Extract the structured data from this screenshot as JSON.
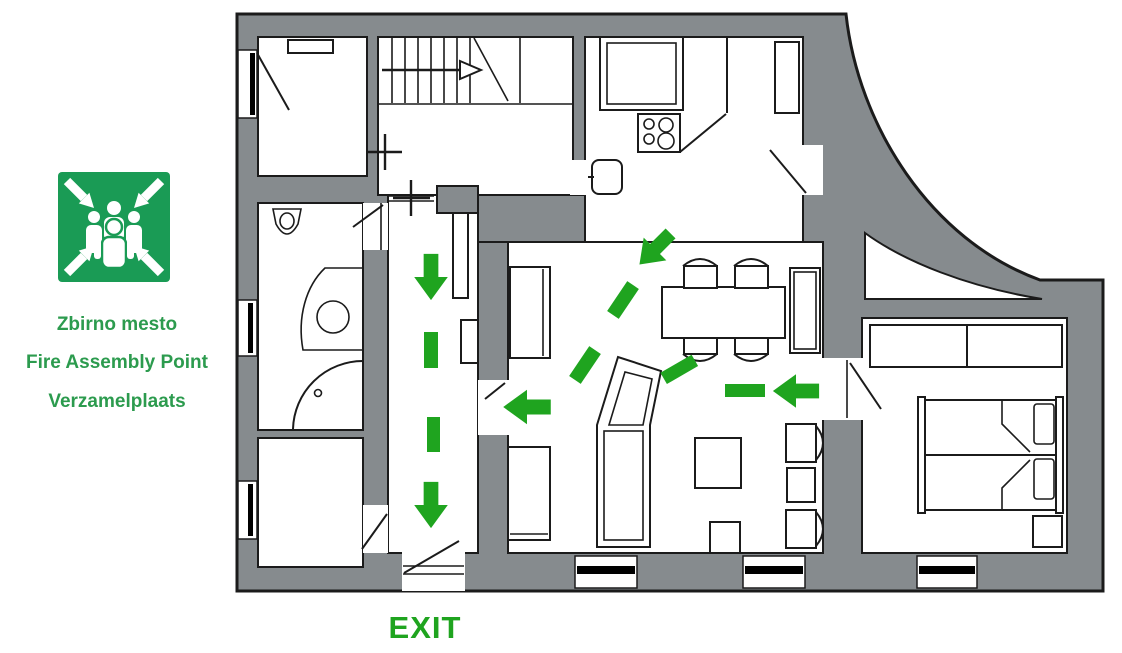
{
  "sign": {
    "icon": "fire-assembly-point",
    "lines": [
      "Zbirno mesto",
      "Fire Assembly Point",
      "Verzamelplaats"
    ]
  },
  "plan": {
    "exit_label": "EXIT",
    "route_arrow_count": 5,
    "route_dash_count": 6
  },
  "colors": {
    "route_green": "#1fa41f",
    "sign_green": "#1a9b55",
    "text_green": "#2c9b4e",
    "wall_gray": "#868b8e",
    "line_black": "#1b1b1b"
  }
}
